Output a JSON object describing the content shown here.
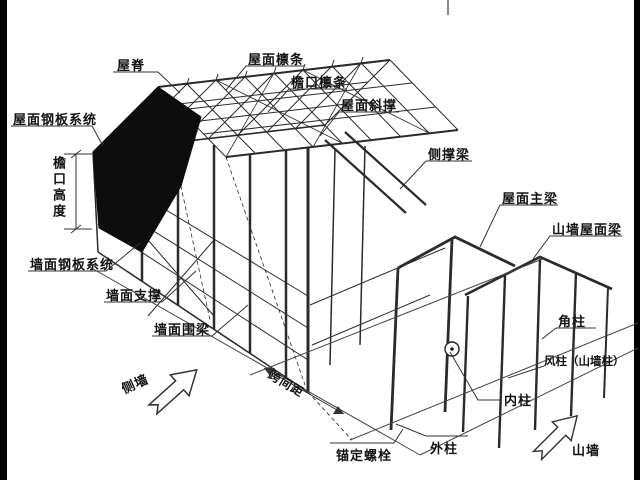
{
  "diagram": {
    "title_hint": "steel-structure-building-exploded-isometric",
    "colors": {
      "background": "#ffffff",
      "line": "#2a2a2a",
      "panel_fill": "#0d0d0d",
      "edge_bar": "#000000",
      "leader": "#333333"
    },
    "labels": {
      "ridge": "屋脊",
      "roof_purlin": "屋面檩条",
      "eave_purlin": "檐口檩条",
      "roof_brace": "屋面斜撑",
      "side_brace_beam": "侧撑梁",
      "roof_main_beam": "屋面主梁",
      "gable_roof_beam": "山墙屋面梁",
      "corner_column": "角柱",
      "wind_column": "风柱（山墙柱）",
      "inner_column": "内柱",
      "outer_column": "外柱",
      "anchor_bolt": "锚定螺栓",
      "wall_girt": "墙面围梁",
      "wall_brace": "墙面支撑",
      "wall_panel_system": "墙面钢板系统",
      "roof_panel_system": "屋面钢板系统",
      "eave_height": "檐口高度",
      "span_spacing": "跨间距",
      "side_wall": "侧墙",
      "gable_wall": "山墙"
    },
    "symbols": {
      "column_marker": "circle-with-center-dot",
      "direction_arrows": [
        "side-wall-arrow",
        "gable-wall-arrow"
      ]
    }
  }
}
